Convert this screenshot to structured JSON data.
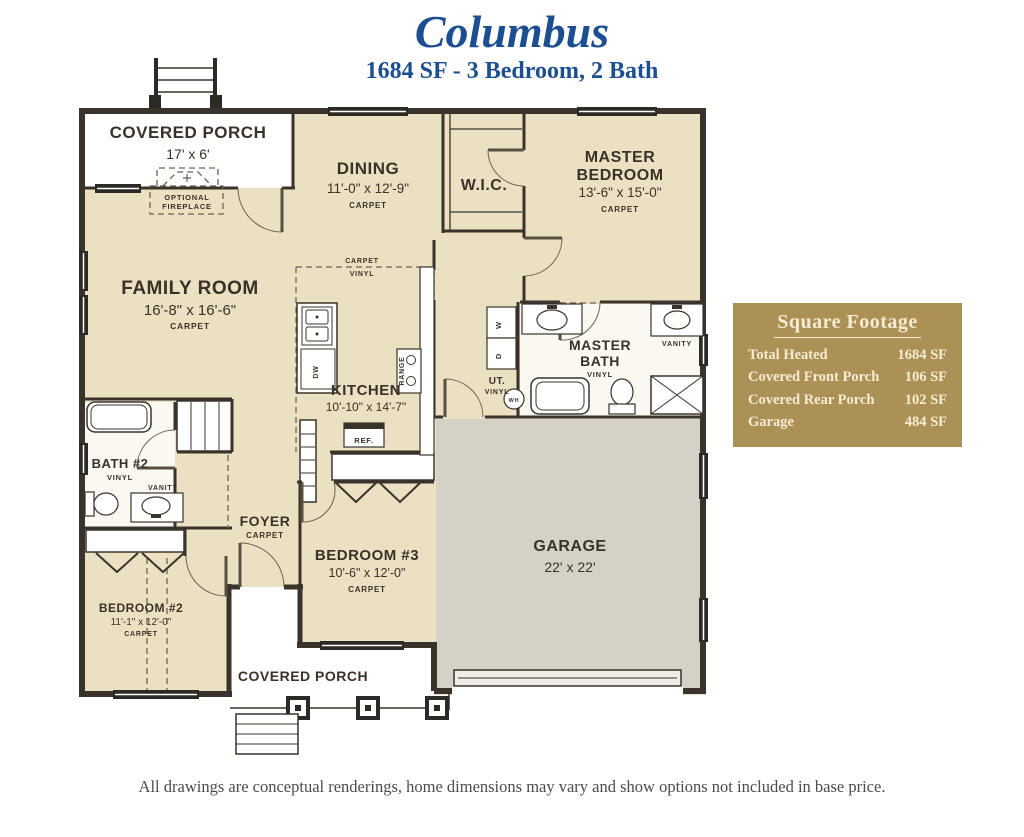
{
  "header": {
    "title": "Columbus",
    "subtitle": "1684 SF - 3 Bedroom, 2 Bath"
  },
  "plan": {
    "covered_porch_rear": {
      "name": "COVERED PORCH",
      "dims": "17' x 6'"
    },
    "optional_fireplace": {
      "line1": "OPTIONAL",
      "line2": "FIREPLACE"
    },
    "dining": {
      "name": "DINING",
      "dims": "11'-0\" x 12'-9\"",
      "floor": "CARPET"
    },
    "wic": {
      "name": "W.I.C."
    },
    "master_bedroom": {
      "line1": "MASTER",
      "line2": "BEDROOM",
      "dims": "13'-6\" x 15'-0\"",
      "floor": "CARPET"
    },
    "family_room": {
      "name": "FAMILY ROOM",
      "dims": "16'-8\" x 16'-6\"",
      "floor": "CARPET"
    },
    "kitchen": {
      "name": "KITCHEN",
      "dims": "10'-10\" x 14'-7\""
    },
    "transition": {
      "carpet": "CARPET",
      "vinyl": "VINYL"
    },
    "utility": {
      "name": "UT.",
      "floor": "VINYL",
      "water_heater": "WH",
      "washer": "W",
      "dryer": "D"
    },
    "master_bath": {
      "line1": "MASTER",
      "line2": "BATH",
      "floor": "VINYL",
      "vanity": "VANITY"
    },
    "bath2": {
      "name": "BATH #2",
      "floor": "VINYL",
      "vanity": "VANITY"
    },
    "foyer": {
      "name": "FOYER",
      "floor": "CARPET"
    },
    "bedroom3": {
      "name": "BEDROOM #3",
      "dims": "10'-6\" x 12'-0\"",
      "floor": "CARPET"
    },
    "bedroom2": {
      "name": "BEDROOM #2",
      "dims": "11'-1\" x 12'-0\"",
      "floor": "CARPET"
    },
    "garage": {
      "name": "GARAGE",
      "dims": "22' x 22'"
    },
    "covered_porch_front": {
      "name": "COVERED PORCH"
    },
    "appliances": {
      "range": "RANGE",
      "refrigerator": "REF.",
      "dishwasher": "DW"
    }
  },
  "square_footage": {
    "title": "Square Footage",
    "rows": [
      {
        "label": "Total Heated",
        "value": "1684 SF"
      },
      {
        "label": "Covered Front Porch",
        "value": "106 SF"
      },
      {
        "label": "Covered Rear Porch",
        "value": "102 SF"
      },
      {
        "label": "Garage",
        "value": "484 SF"
      }
    ]
  },
  "footer": {
    "disclaimer": "All drawings are conceptual renderings, home dimensions may vary and show options not included in base price."
  },
  "colors": {
    "accent_blue": "#1c4e92",
    "panel_gold": "#ac9156",
    "room_cream": "#ece0c3",
    "garage_gray": "#d4d1c7",
    "wall_dark": "#39332b"
  }
}
